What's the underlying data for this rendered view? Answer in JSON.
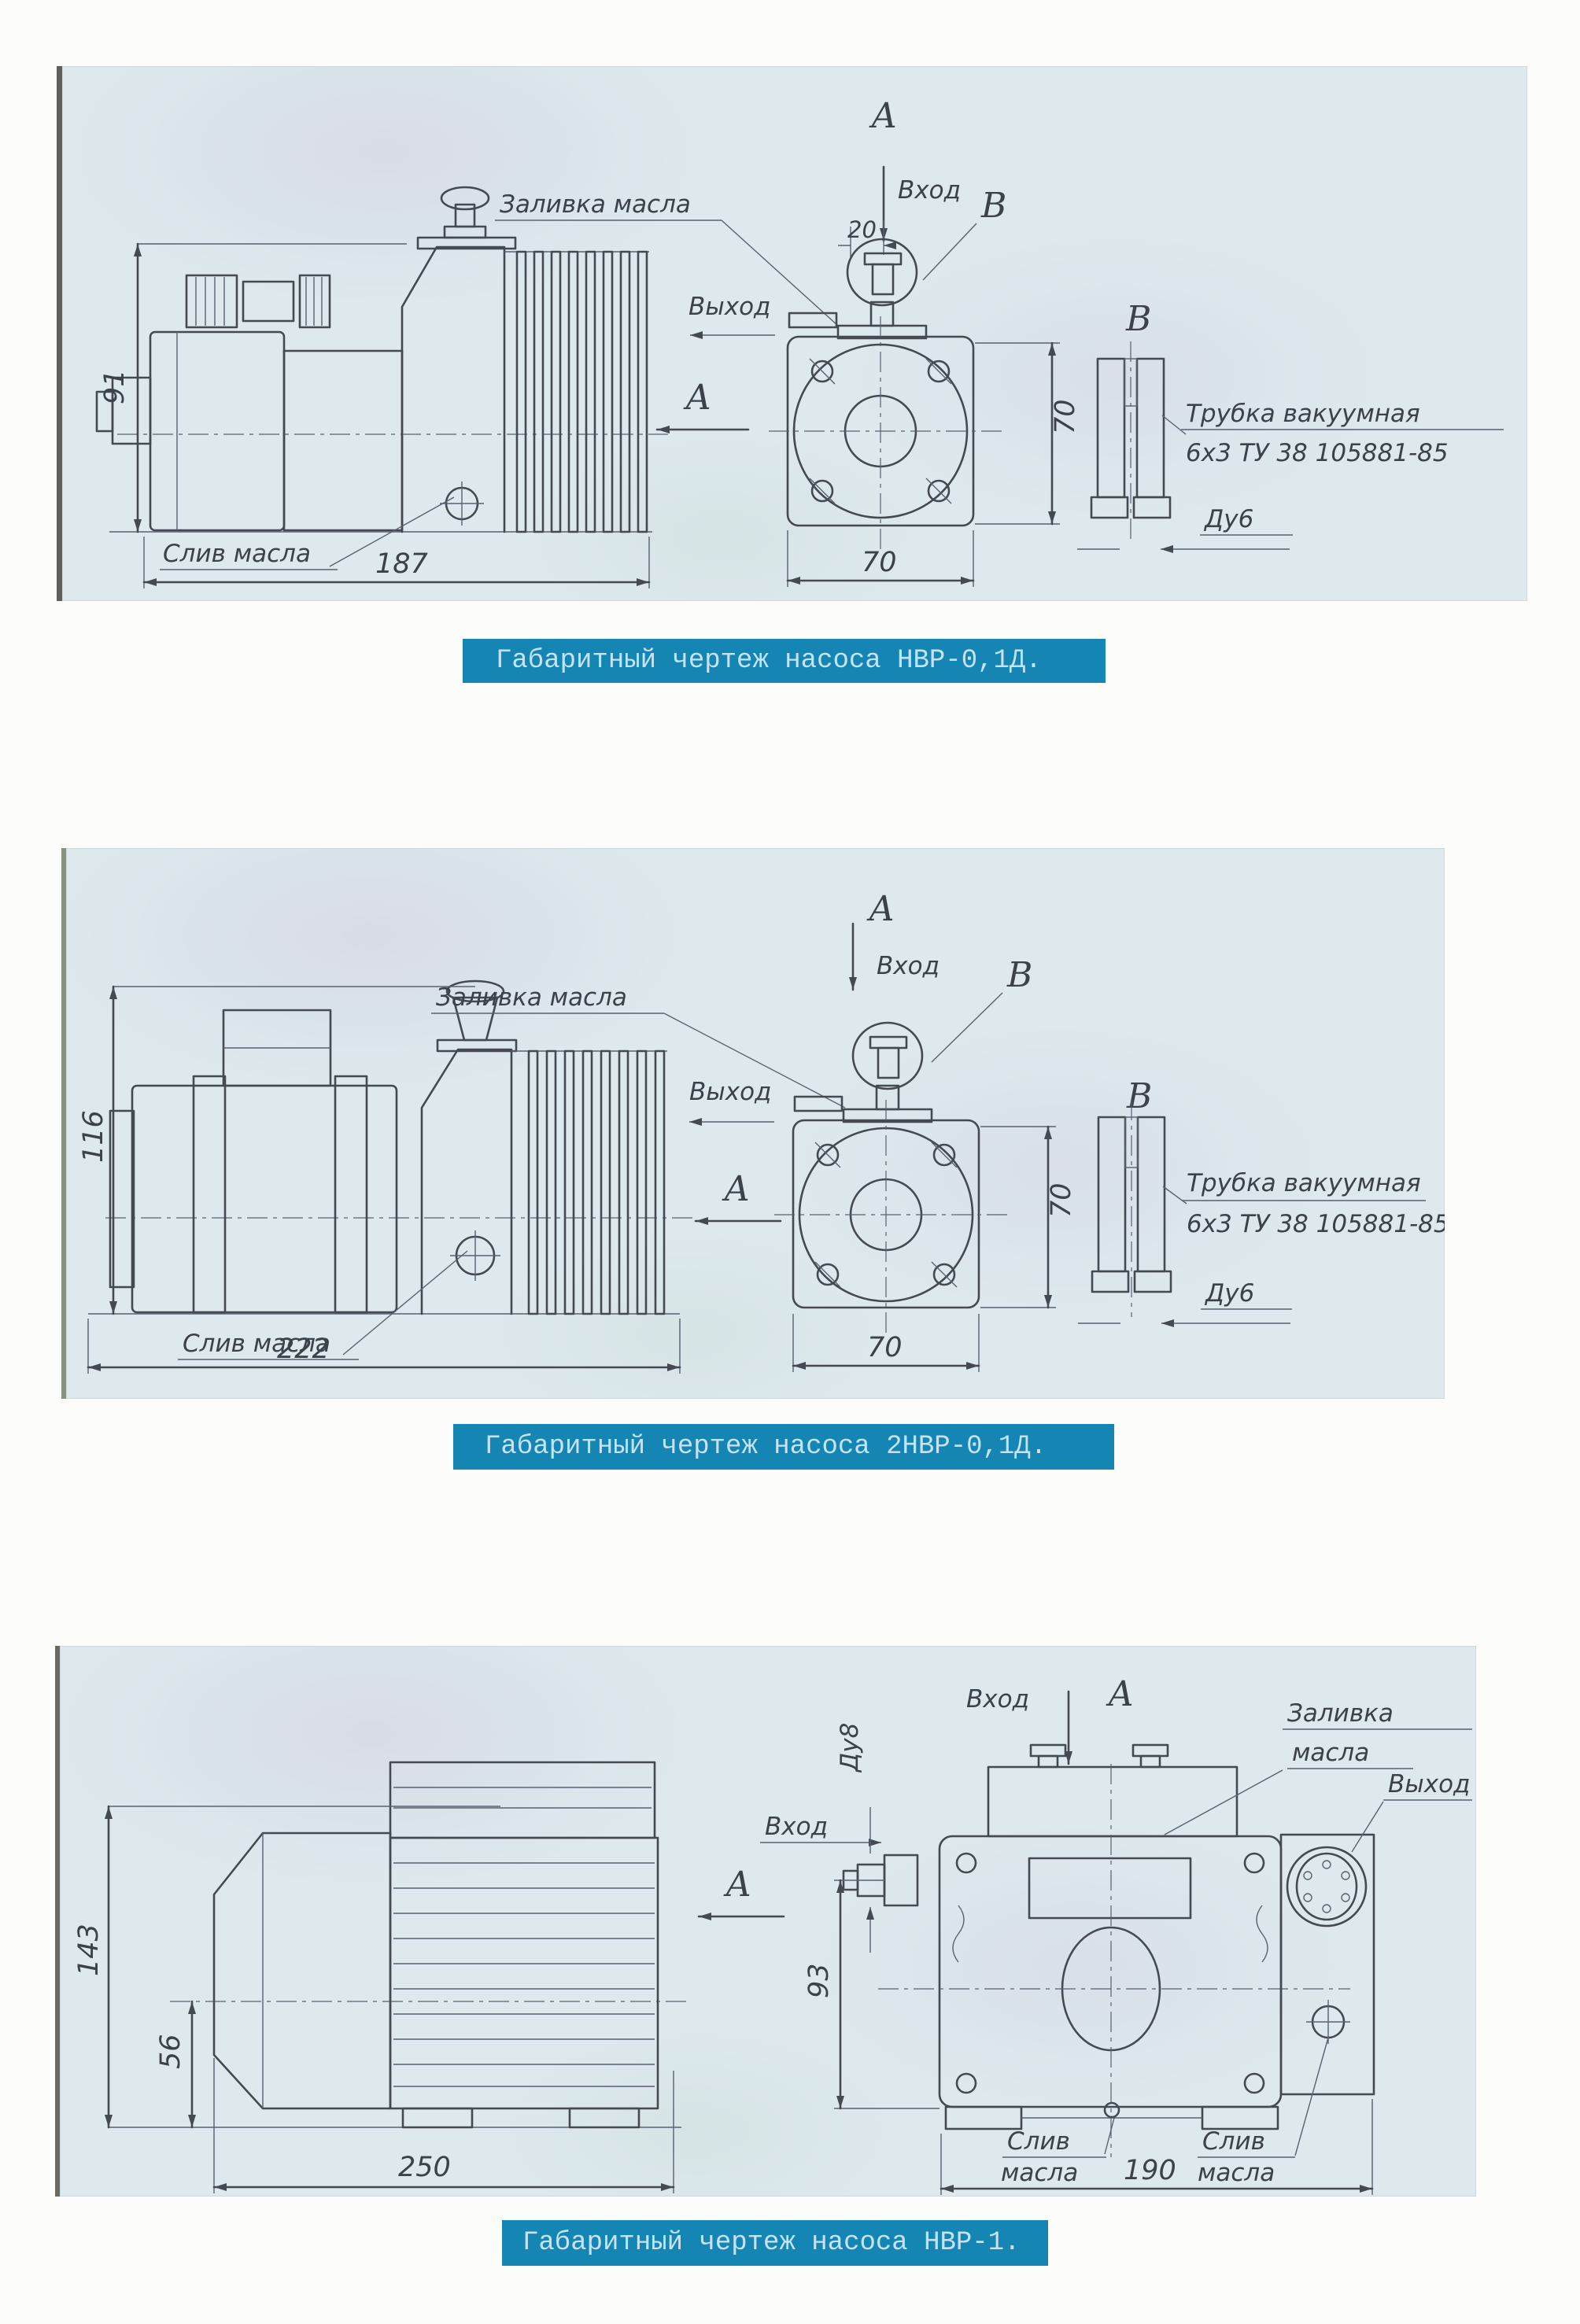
{
  "page": {
    "background": "#fcfcfa",
    "panel_background": "#dde9ed",
    "caption_background": "#1586b4",
    "caption_color": "#c6e3f3",
    "line_color": "#454a52"
  },
  "figures": [
    {
      "caption": "Габаритный чертеж насоса НВР-0,1Д.",
      "labels": {
        "view_top": "А",
        "inlet": "Вход",
        "outlet": "Выход",
        "oil_fill": "Заливка масла",
        "oil_drain": "Слив масла",
        "section": "В",
        "section_view": "В",
        "view_arrow": "А",
        "tube_note_1": "Трубка вакуумная",
        "tube_note_2": "6х3 ТУ 38 105881-85",
        "bore": "Ду6"
      },
      "dims": {
        "overall_height": "91",
        "overall_length": "187",
        "inlet_offset": "20",
        "flange_height": "70",
        "flange_width": "70"
      }
    },
    {
      "caption": "Габаритный чертеж насоса 2НВР-0,1Д.",
      "labels": {
        "view_top": "А",
        "inlet": "Вход",
        "outlet": "Выход",
        "oil_fill": "Заливка масла",
        "oil_drain": "Слив масла",
        "section": "В",
        "section_view": "В",
        "view_arrow": "А",
        "tube_note_1": "Трубка вакуумная",
        "tube_note_2": "6х3 ТУ 38 105881-85",
        "bore": "Ду6"
      },
      "dims": {
        "overall_height": "116",
        "overall_length": "222",
        "flange_height": "70",
        "flange_width": "70"
      }
    },
    {
      "caption": "Габаритный чертеж насоса НВР-1.",
      "labels": {
        "inlet_top": "Вход",
        "view_top": "А",
        "oil_fill_1": "Заливка",
        "oil_fill_2": "масла",
        "outlet": "Выход",
        "inlet_side": "Вход",
        "bore": "Ду8",
        "view_arrow": "А",
        "drain_word_1": "Слив",
        "drain_word_2": "масла"
      },
      "dims": {
        "overall_height": "143",
        "axis_height": "56",
        "overall_length": "250",
        "inlet_height": "93",
        "mount_length": "190"
      }
    }
  ]
}
